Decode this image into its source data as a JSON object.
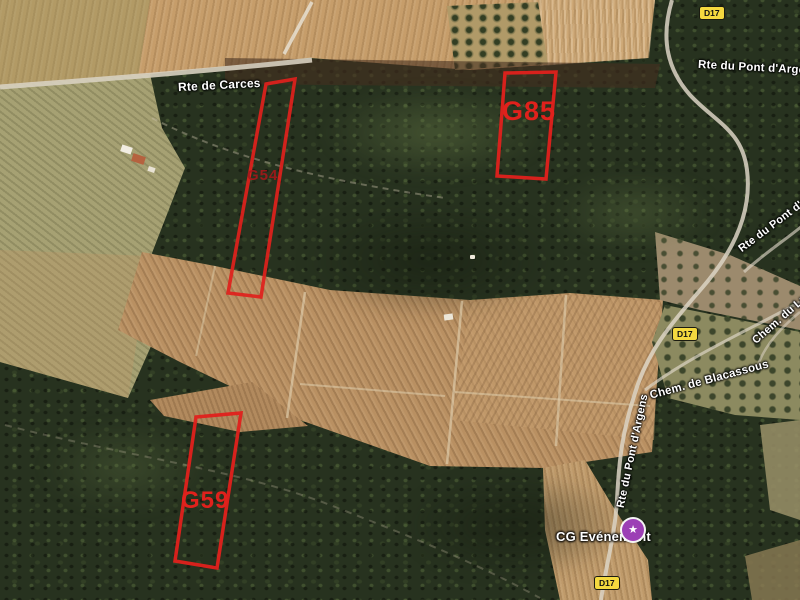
{
  "map": {
    "parcel_outline_color": "#e0211c",
    "parcels": [
      {
        "label": "G54",
        "points": "266,84 295,79 261,297 228,293"
      },
      {
        "label": "G85",
        "points": "505,73 556,72 546,179 497,176"
      },
      {
        "label": "G59",
        "points": "196,417 241,413 217,568 175,561"
      }
    ],
    "road_labels": {
      "rte_de_carces": "Rte de Carces",
      "rte_du_pont_argens_top": "Rte du Pont d'Argens",
      "rte_du_pont_argens_right": "Rte du Pont d'A",
      "rte_du_pont_argens_mid": "Rte du Pont d'Argens",
      "chem_du_lu": "Chem. du Lu",
      "chem_de_blacassous": "Chem. de Blacassous"
    },
    "route_shield": "D17",
    "shield_color": "#f5d93f",
    "poi": {
      "label": "CG Evénement",
      "icon": "star-icon",
      "glyph": "★",
      "color": "#9c3fb5"
    }
  }
}
